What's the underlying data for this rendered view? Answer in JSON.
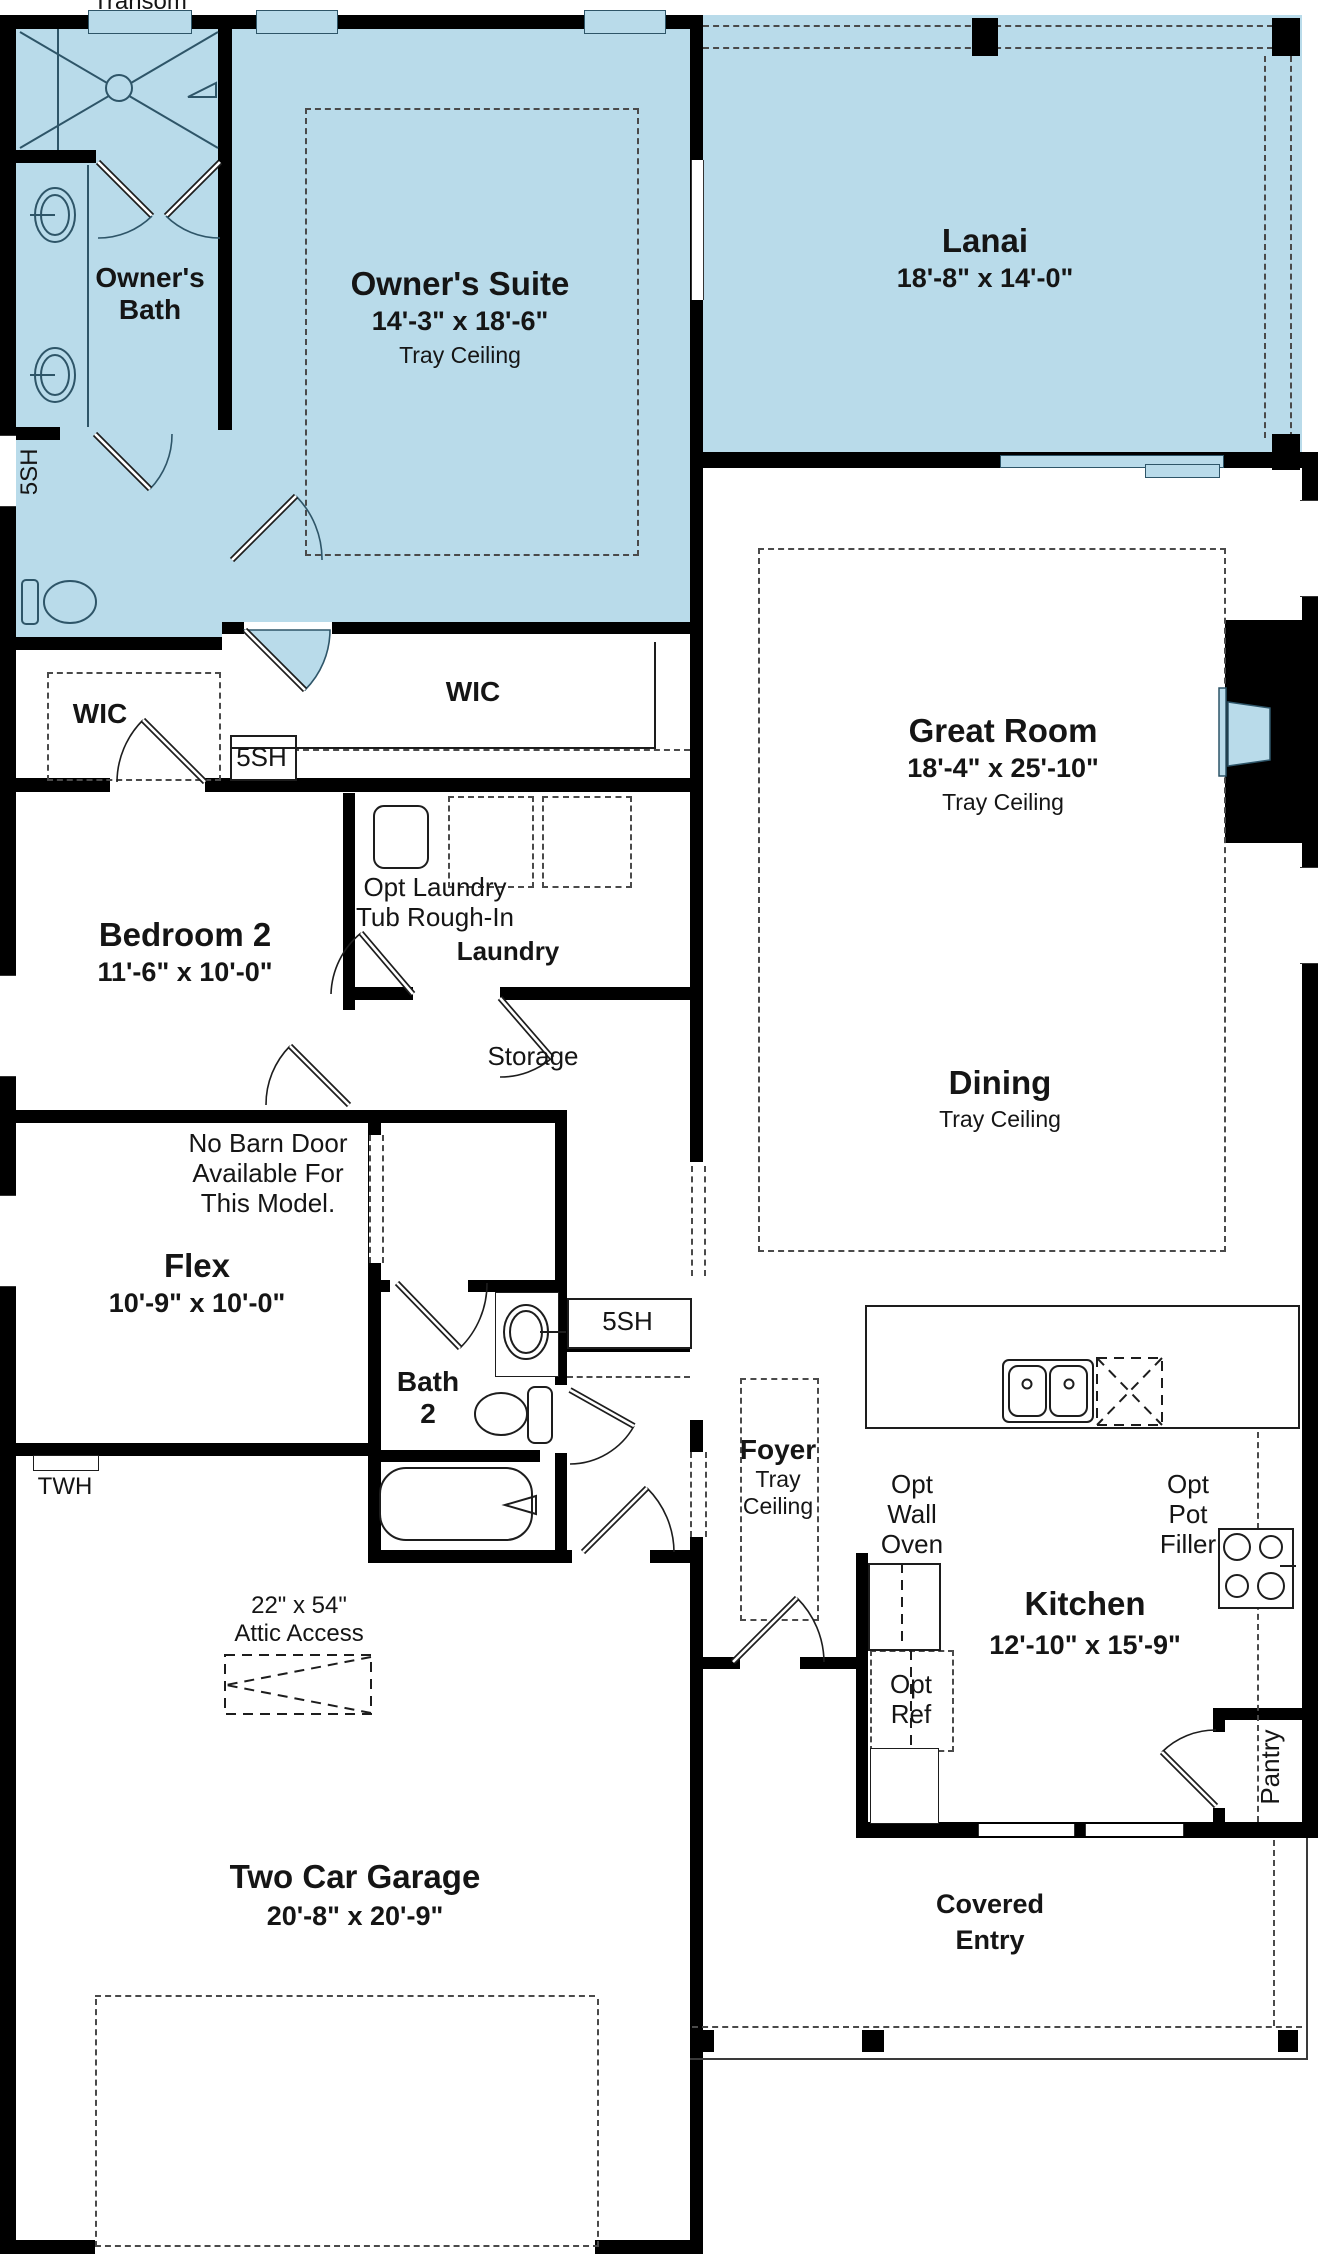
{
  "plan": {
    "transom": "Transom",
    "windows": {
      "sh_left": "5SH",
      "sh_wic": "5SH",
      "sh_hall": "5SH"
    },
    "rooms": {
      "owners_bath": {
        "name": "Owner's\nBath"
      },
      "owners_suite": {
        "name": "Owner's Suite",
        "dims": "14'-3\" x 18'-6\"",
        "note": "Tray Ceiling"
      },
      "lanai": {
        "name": "Lanai",
        "dims": "18'-8\" x 14'-0\""
      },
      "great_room": {
        "name": "Great Room",
        "dims": "18'-4\" x 25'-10\"",
        "note": "Tray Ceiling"
      },
      "wic_left": {
        "name": "WIC"
      },
      "wic_main": {
        "name": "WIC"
      },
      "bedroom2": {
        "name": "Bedroom 2",
        "dims": "11'-6\" x 10'-0\""
      },
      "laundry": {
        "name": "Laundry",
        "opt_note": "Opt Laundry\nTub Rough-In"
      },
      "storage": {
        "name": "Storage"
      },
      "dining": {
        "name": "Dining",
        "note": "Tray Ceiling"
      },
      "flex": {
        "name": "Flex",
        "dims": "10'-9\" x 10'-0\"",
        "note": "No Barn Door\nAvailable For\nThis Model."
      },
      "bath2": {
        "name": "Bath\n2"
      },
      "foyer": {
        "name": "Foyer",
        "note": "Tray\nCeiling"
      },
      "kitchen": {
        "name": "Kitchen",
        "dims": "12'-10\" x 15'-9\"",
        "opt_wall_oven": "Opt\nWall\nOven",
        "opt_pot_filler": "Opt\nPot\nFiller",
        "opt_ref": "Opt\nRef"
      },
      "pantry": {
        "name": "Pantry"
      },
      "garage": {
        "name": "Two Car Garage",
        "dims": "20'-8\" x 20'-9\"",
        "attic_note": "22\" x 54\"\nAttic Access",
        "twh": "TWH"
      },
      "covered_entry": {
        "name": "Covered\nEntry"
      }
    },
    "colors": {
      "room_fill": "#b9dbea",
      "wall": "#000000",
      "fixture_line": "#2e5568",
      "text": "#151515"
    }
  }
}
